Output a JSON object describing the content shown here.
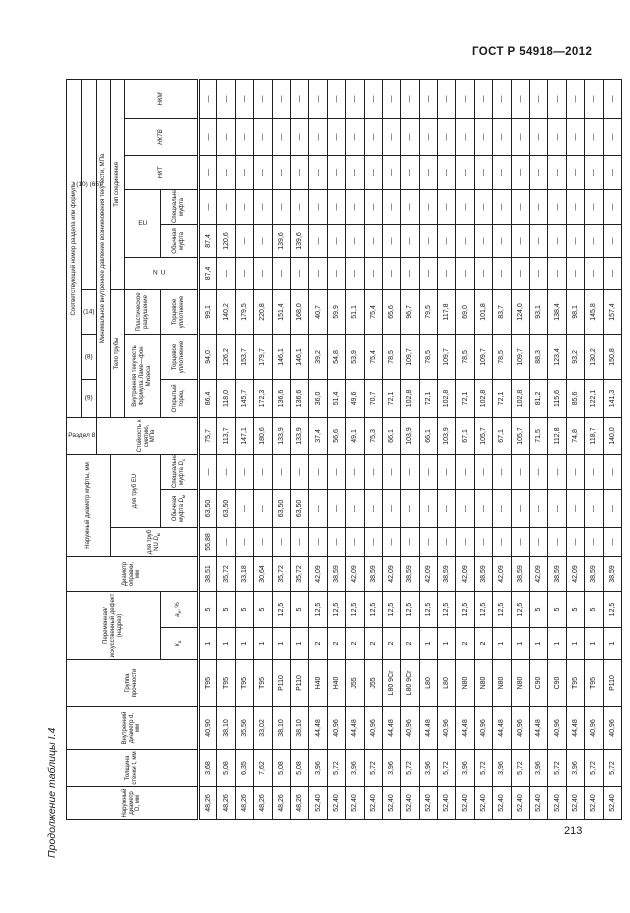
{
  "page": {
    "doc_number": "ГОСТ Р 54918—2012",
    "table_caption": "Продолжение таблицы I.4",
    "page_number": "213"
  },
  "table": {
    "headers": {
      "d_out": "Наружный диаметр D, мм",
      "t": "Толщина стенки t, мм",
      "d_in": "Внутренний диаметр d, мм",
      "grade": "Группа прочности",
      "notch": "Переменная/ искусственный дефект (надрез)",
      "notch_k": {
        "sym": "k",
        "sub": "а"
      },
      "notch_a": {
        "sym": "a",
        "sub": "н",
        "suffix": ", %"
      },
      "mandrel": "Диаметр оправки, мм",
      "coupling_od": "Наружный диаметр муфты, мм",
      "nu_pipe": {
        "text": "для труб NU",
        "sym": "D",
        "sub": "м"
      },
      "eu_pipe": "для труб EU",
      "eu_regular_d": {
        "text": "Обычная муфта",
        "sym": "D",
        "sub": "м"
      },
      "eu_special_d": {
        "text": "Специальная муфта",
        "sym": "D",
        "sub": "с"
      },
      "section8": "Раздел 8",
      "section_ref": "Соответствующий номер раздела или формулы",
      "f9": "(9)",
      "f8": "(8)",
      "f14": "(14)",
      "f10_65": "(10) (65)",
      "collapse": "Стойкость к смятию, МПа",
      "min_yield": "Минимальное внутреннее давление возникновения текучести, МПа",
      "pipe_body": "Тело трубы",
      "conn_type": "Тип соединения",
      "internal_yield": "Внутренняя текучесть",
      "lame": "Формула Ламе—фон Мизеса",
      "plastic": "Пластическое разрушение",
      "open_end": "Открытый торец",
      "end_seal_8": "Торцевое уплотнение",
      "end_seal_14": "Торцевое уплотнение",
      "nu": "NU",
      "eu": "EU",
      "regular_coupling": "Обычная муфта",
      "special_coupling": "Специальная муфта",
      "nkt": "НКТ",
      "nktv": "НКТВ",
      "nkm": "НКМ"
    },
    "rows": [
      {
        "d_out": "48,26",
        "t": "3,68",
        "d_in": "40,90",
        "grade": "T95",
        "k": "1",
        "a": "5",
        "mandrel": "38,51",
        "nu_dm": "55,88",
        "eu_dm": "63,50",
        "eu_ds": "—",
        "collapse": "75,7",
        "open_end": "86,4",
        "seal8": "94,0",
        "seal14": "99,1",
        "conn_nu": "87,4",
        "conn_eu_reg": "87,4",
        "conn_eu_spec": "—",
        "nkt": "—",
        "nktv": "—",
        "nkm": "—"
      },
      {
        "d_out": "48,26",
        "t": "5,08",
        "d_in": "38,10",
        "grade": "T95",
        "k": "1",
        "a": "5",
        "mandrel": "35,72",
        "nu_dm": "—",
        "eu_dm": "63,50",
        "eu_ds": "—",
        "collapse": "113,7",
        "open_end": "118,0",
        "seal8": "126,2",
        "seal14": "140,2",
        "conn_nu": "—",
        "conn_eu_reg": "120,6",
        "conn_eu_spec": "—",
        "nkt": "—",
        "nktv": "—",
        "nkm": "—"
      },
      {
        "d_out": "48,26",
        "t": "6,35",
        "d_in": "35,56",
        "grade": "T95",
        "k": "1",
        "a": "5",
        "mandrel": "33,18",
        "nu_dm": "—",
        "eu_dm": "—",
        "eu_ds": "—",
        "collapse": "147,1",
        "open_end": "145,7",
        "seal8": "153,7",
        "seal14": "179,5",
        "conn_nu": "—",
        "conn_eu_reg": "—",
        "conn_eu_spec": "—",
        "nkt": "—",
        "nktv": "—",
        "nkm": "—"
      },
      {
        "d_out": "48,26",
        "t": "7,62",
        "d_in": "33,02",
        "grade": "T95",
        "k": "1",
        "a": "5",
        "mandrel": "30,64",
        "nu_dm": "—",
        "eu_dm": "—",
        "eu_ds": "—",
        "collapse": "180,6",
        "open_end": "172,3",
        "seal8": "179,7",
        "seal14": "220,8",
        "conn_nu": "—",
        "conn_eu_reg": "—",
        "conn_eu_spec": "—",
        "nkt": "—",
        "nktv": "—",
        "nkm": "—"
      },
      {
        "d_out": "48,26",
        "t": "5,08",
        "d_in": "38,10",
        "grade": "P110",
        "k": "1",
        "a": "12,5",
        "mandrel": "35,72",
        "nu_dm": "—",
        "eu_dm": "63,50",
        "eu_ds": "—",
        "collapse": "133,9",
        "open_end": "136,6",
        "seal8": "146,1",
        "seal14": "151,4",
        "conn_nu": "—",
        "conn_eu_reg": "139,6",
        "conn_eu_spec": "—",
        "nkt": "—",
        "nktv": "—",
        "nkm": "—"
      },
      {
        "d_out": "48,26",
        "t": "5,08",
        "d_in": "38,10",
        "grade": "P110",
        "k": "1",
        "a": "5",
        "mandrel": "35,72",
        "nu_dm": "—",
        "eu_dm": "63,50",
        "eu_ds": "—",
        "collapse": "133,9",
        "open_end": "136,6",
        "seal8": "146,1",
        "seal14": "168,0",
        "conn_nu": "—",
        "conn_eu_reg": "139,6",
        "conn_eu_spec": "—",
        "nkt": "—",
        "nktv": "—",
        "nkm": "—"
      },
      {
        "d_out": "52,40",
        "t": "3,96",
        "d_in": "44,48",
        "grade": "H40",
        "k": "2",
        "a": "12,5",
        "mandrel": "42,09",
        "nu_dm": "—",
        "eu_dm": "—",
        "eu_ds": "—",
        "collapse": "37,4",
        "open_end": "36,0",
        "seal8": "39,2",
        "seal14": "40,7",
        "conn_nu": "—",
        "conn_eu_reg": "—",
        "conn_eu_spec": "—",
        "nkt": "—",
        "nktv": "—",
        "nkm": "—"
      },
      {
        "d_out": "52,40",
        "t": "5,72",
        "d_in": "40,96",
        "grade": "H40",
        "k": "2",
        "a": "12,5",
        "mandrel": "38,59",
        "nu_dm": "—",
        "eu_dm": "—",
        "eu_ds": "—",
        "collapse": "56,6",
        "open_end": "51,4",
        "seal8": "54,8",
        "seal14": "59,9",
        "conn_nu": "—",
        "conn_eu_reg": "—",
        "conn_eu_spec": "—",
        "nkt": "—",
        "nktv": "—",
        "nkm": "—"
      },
      {
        "d_out": "52,40",
        "t": "3,96",
        "d_in": "44,48",
        "grade": "J55",
        "k": "2",
        "a": "12,5",
        "mandrel": "42,09",
        "nu_dm": "—",
        "eu_dm": "—",
        "eu_ds": "—",
        "collapse": "49,1",
        "open_end": "49,6",
        "seal8": "53,9",
        "seal14": "51,1",
        "conn_nu": "—",
        "conn_eu_reg": "—",
        "conn_eu_spec": "—",
        "nkt": "—",
        "nktv": "—",
        "nkm": "—"
      },
      {
        "d_out": "52,40",
        "t": "5,72",
        "d_in": "40,96",
        "grade": "J55",
        "k": "2",
        "a": "12,5",
        "mandrel": "38,59",
        "nu_dm": "—",
        "eu_dm": "—",
        "eu_ds": "—",
        "collapse": "75,3",
        "open_end": "70,7",
        "seal8": "75,4",
        "seal14": "75,4",
        "conn_nu": "—",
        "conn_eu_reg": "—",
        "conn_eu_spec": "—",
        "nkt": "—",
        "nktv": "—",
        "nkm": "—"
      },
      {
        "d_out": "52,40",
        "t": "3,96",
        "d_in": "44,48",
        "grade": "L80 9Cr",
        "k": "2",
        "a": "12,5",
        "mandrel": "42,09",
        "nu_dm": "—",
        "eu_dm": "—",
        "eu_ds": "—",
        "collapse": "66,1",
        "open_end": "72,1",
        "seal8": "78,5",
        "seal14": "65,6",
        "conn_nu": "—",
        "conn_eu_reg": "—",
        "conn_eu_spec": "—",
        "nkt": "—",
        "nktv": "—",
        "nkm": "—"
      },
      {
        "d_out": "52,40",
        "t": "5,72",
        "d_in": "40,96",
        "grade": "L80 9Cr",
        "k": "2",
        "a": "12,5",
        "mandrel": "38,59",
        "nu_dm": "—",
        "eu_dm": "—",
        "eu_ds": "—",
        "collapse": "103,9",
        "open_end": "102,8",
        "seal8": "109,7",
        "seal14": "96,7",
        "conn_nu": "—",
        "conn_eu_reg": "—",
        "conn_eu_spec": "—",
        "nkt": "—",
        "nktv": "—",
        "nkm": "—"
      },
      {
        "d_out": "52,40",
        "t": "3,96",
        "d_in": "44,48",
        "grade": "L80",
        "k": "1",
        "a": "12,5",
        "mandrel": "42,09",
        "nu_dm": "—",
        "eu_dm": "—",
        "eu_ds": "—",
        "collapse": "66,1",
        "open_end": "72,1",
        "seal8": "78,5",
        "seal14": "79,5",
        "conn_nu": "—",
        "conn_eu_reg": "—",
        "conn_eu_spec": "—",
        "nkt": "—",
        "nktv": "—",
        "nkm": "—"
      },
      {
        "d_out": "52,40",
        "t": "5,72",
        "d_in": "40,96",
        "grade": "L80",
        "k": "1",
        "a": "12,5",
        "mandrel": "38,59",
        "nu_dm": "—",
        "eu_dm": "—",
        "eu_ds": "—",
        "collapse": "103,9",
        "open_end": "102,8",
        "seal8": "109,7",
        "seal14": "117,8",
        "conn_nu": "—",
        "conn_eu_reg": "—",
        "conn_eu_spec": "—",
        "nkt": "—",
        "nktv": "—",
        "nkm": "—"
      },
      {
        "d_out": "52,40",
        "t": "3,96",
        "d_in": "44,48",
        "grade": "N80",
        "k": "2",
        "a": "12,5",
        "mandrel": "42,09",
        "nu_dm": "—",
        "eu_dm": "—",
        "eu_ds": "—",
        "collapse": "67,1",
        "open_end": "72,1",
        "seal8": "78,5",
        "seal14": "69,0",
        "conn_nu": "—",
        "conn_eu_reg": "—",
        "conn_eu_spec": "—",
        "nkt": "—",
        "nktv": "—",
        "nkm": "—"
      },
      {
        "d_out": "52,40",
        "t": "5,72",
        "d_in": "40,96",
        "grade": "N80",
        "k": "2",
        "a": "12,5",
        "mandrel": "38,59",
        "nu_dm": "—",
        "eu_dm": "—",
        "eu_ds": "—",
        "collapse": "105,7",
        "open_end": "102,8",
        "seal8": "109,7",
        "seal14": "101,8",
        "conn_nu": "—",
        "conn_eu_reg": "—",
        "conn_eu_spec": "—",
        "nkt": "—",
        "nktv": "—",
        "nkm": "—"
      },
      {
        "d_out": "52,40",
        "t": "3,96",
        "d_in": "44,48",
        "grade": "N80",
        "k": "1",
        "a": "12,5",
        "mandrel": "42,09",
        "nu_dm": "—",
        "eu_dm": "—",
        "eu_ds": "—",
        "collapse": "67,1",
        "open_end": "72,1",
        "seal8": "78,5",
        "seal14": "83,7",
        "conn_nu": "—",
        "conn_eu_reg": "—",
        "conn_eu_spec": "—",
        "nkt": "—",
        "nktv": "—",
        "nkm": "—"
      },
      {
        "d_out": "52,40",
        "t": "5,72",
        "d_in": "40,96",
        "grade": "N80",
        "k": "1",
        "a": "12,5",
        "mandrel": "38,59",
        "nu_dm": "—",
        "eu_dm": "—",
        "eu_ds": "—",
        "collapse": "105,7",
        "open_end": "102,8",
        "seal8": "109,7",
        "seal14": "124,0",
        "conn_nu": "—",
        "conn_eu_reg": "—",
        "conn_eu_spec": "—",
        "nkt": "—",
        "nktv": "—",
        "nkm": "—"
      },
      {
        "d_out": "52,40",
        "t": "3,96",
        "d_in": "44,48",
        "grade": "C90",
        "k": "1",
        "a": "5",
        "mandrel": "42,09",
        "nu_dm": "—",
        "eu_dm": "—",
        "eu_ds": "—",
        "collapse": "71,5",
        "open_end": "81,2",
        "seal8": "88,3",
        "seal14": "93,1",
        "conn_nu": "—",
        "conn_eu_reg": "—",
        "conn_eu_spec": "—",
        "nkt": "—",
        "nktv": "—",
        "nkm": "—"
      },
      {
        "d_out": "52,40",
        "t": "5,72",
        "d_in": "40,96",
        "grade": "C90",
        "k": "1",
        "a": "5",
        "mandrel": "38,59",
        "nu_dm": "—",
        "eu_dm": "—",
        "eu_ds": "—",
        "collapse": "112,8",
        "open_end": "115,6",
        "seal8": "123,4",
        "seal14": "138,4",
        "conn_nu": "—",
        "conn_eu_reg": "—",
        "conn_eu_spec": "—",
        "nkt": "—",
        "nktv": "—",
        "nkm": "—"
      },
      {
        "d_out": "52,40",
        "t": "3,96",
        "d_in": "44,48",
        "grade": "T95",
        "k": "1",
        "a": "5",
        "mandrel": "42,09",
        "nu_dm": "—",
        "eu_dm": "—",
        "eu_ds": "—",
        "collapse": "74,8",
        "open_end": "85,6",
        "seal8": "93,2",
        "seal14": "98,1",
        "conn_nu": "—",
        "conn_eu_reg": "—",
        "conn_eu_spec": "—",
        "nkt": "—",
        "nktv": "—",
        "nkm": "—"
      },
      {
        "d_out": "52,40",
        "t": "5,72",
        "d_in": "40,96",
        "grade": "T95",
        "k": "1",
        "a": "5",
        "mandrel": "38,59",
        "nu_dm": "—",
        "eu_dm": "—",
        "eu_ds": "—",
        "collapse": "118,7",
        "open_end": "122,1",
        "seal8": "130,2",
        "seal14": "145,8",
        "conn_nu": "—",
        "conn_eu_reg": "—",
        "conn_eu_spec": "—",
        "nkt": "—",
        "nktv": "—",
        "nkm": "—"
      },
      {
        "d_out": "52,40",
        "t": "5,72",
        "d_in": "40,96",
        "grade": "P110",
        "k": "1",
        "a": "12,5",
        "mandrel": "38,59",
        "nu_dm": "—",
        "eu_dm": "—",
        "eu_ds": "—",
        "collapse": "140,0",
        "open_end": "141,3",
        "seal8": "150,8",
        "seal14": "157,4",
        "conn_nu": "—",
        "conn_eu_reg": "—",
        "conn_eu_spec": "—",
        "nkt": "—",
        "nktv": "—",
        "nkm": "—"
      }
    ]
  }
}
